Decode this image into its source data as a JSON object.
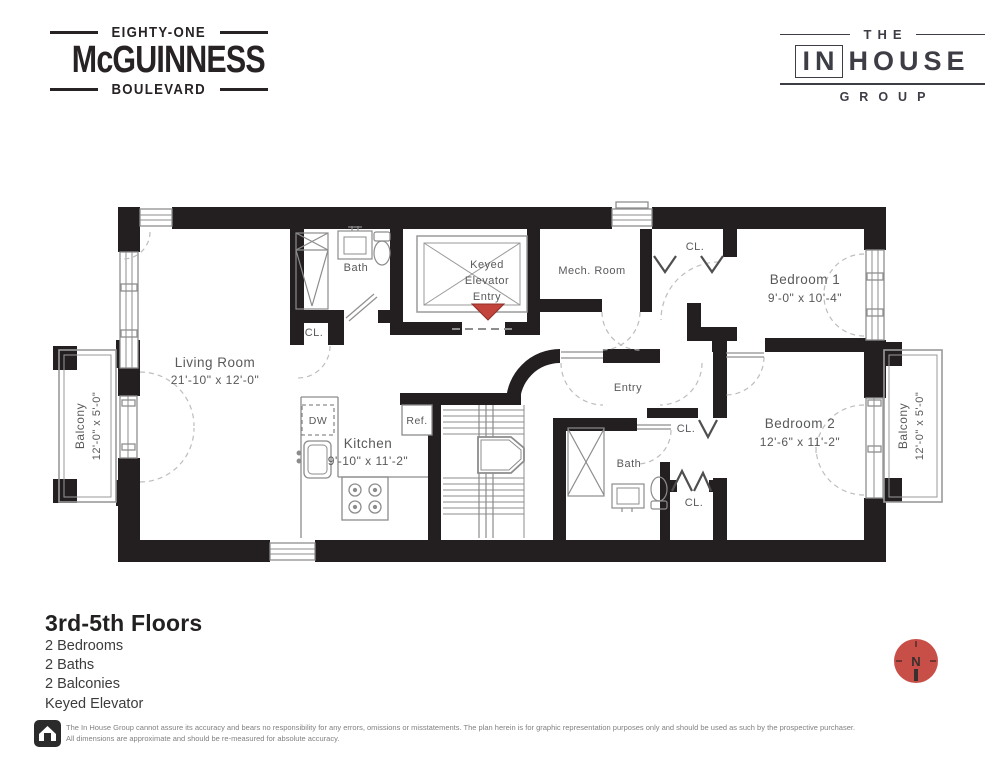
{
  "header": {
    "building_logo": {
      "line1": "EIGHTY-ONE",
      "line2": "McGUINNESS",
      "line3": "BOULEVARD"
    },
    "brokerage_logo": {
      "line1": "THE",
      "boxed": "IN",
      "rest": "HOUSE",
      "line3": "GROUP"
    }
  },
  "plan": {
    "living_room": {
      "name": "Living Room",
      "dims": "21'-10\" x 12'-0\""
    },
    "kitchen": {
      "name": "Kitchen",
      "dims": "9'-10\" x 11'-2\""
    },
    "bedroom1": {
      "name": "Bedroom 1",
      "dims": "9'-0\" x 10'-4\""
    },
    "bedroom2": {
      "name": "Bedroom 2",
      "dims": "12'-6\" x 11'-2\""
    },
    "balcony_left": {
      "name": "Balcony",
      "dims": "12'-0\" x 5'-0\""
    },
    "balcony_right": {
      "name": "Balcony",
      "dims": "12'-0\" x 5'-0\""
    },
    "bath_upper": "Bath",
    "bath_lower": "Bath",
    "mech_room": "Mech. Room",
    "entry": "Entry",
    "elevator": {
      "line1": "Keyed",
      "line2": "Elevator",
      "line3": "Entry"
    },
    "closet1": "CL.",
    "closet2": "CL.",
    "closet3": "CL.",
    "closet4": "CL.",
    "ref": "Ref.",
    "dw": "DW",
    "colors": {
      "wall": "#231f20",
      "accent_red": "#c2443b",
      "label": "#58595b"
    }
  },
  "summary": {
    "title": "3rd-5th Floors",
    "features": [
      "2 Bedrooms",
      "2 Baths",
      "2 Balconies",
      "Keyed Elevator"
    ]
  },
  "compass": {
    "label": "N",
    "color": "#c84f48"
  },
  "disclaimer": {
    "line1": "The In House Group cannot assure its accuracy and bears no responsibility for any errors, omissions or misstatements. The plan herein is for graphic representation purposes only and should be used as such by the prospective purchaser.",
    "line2": "All dimensions are approximate and should be re-measured for absolute accuracy."
  }
}
